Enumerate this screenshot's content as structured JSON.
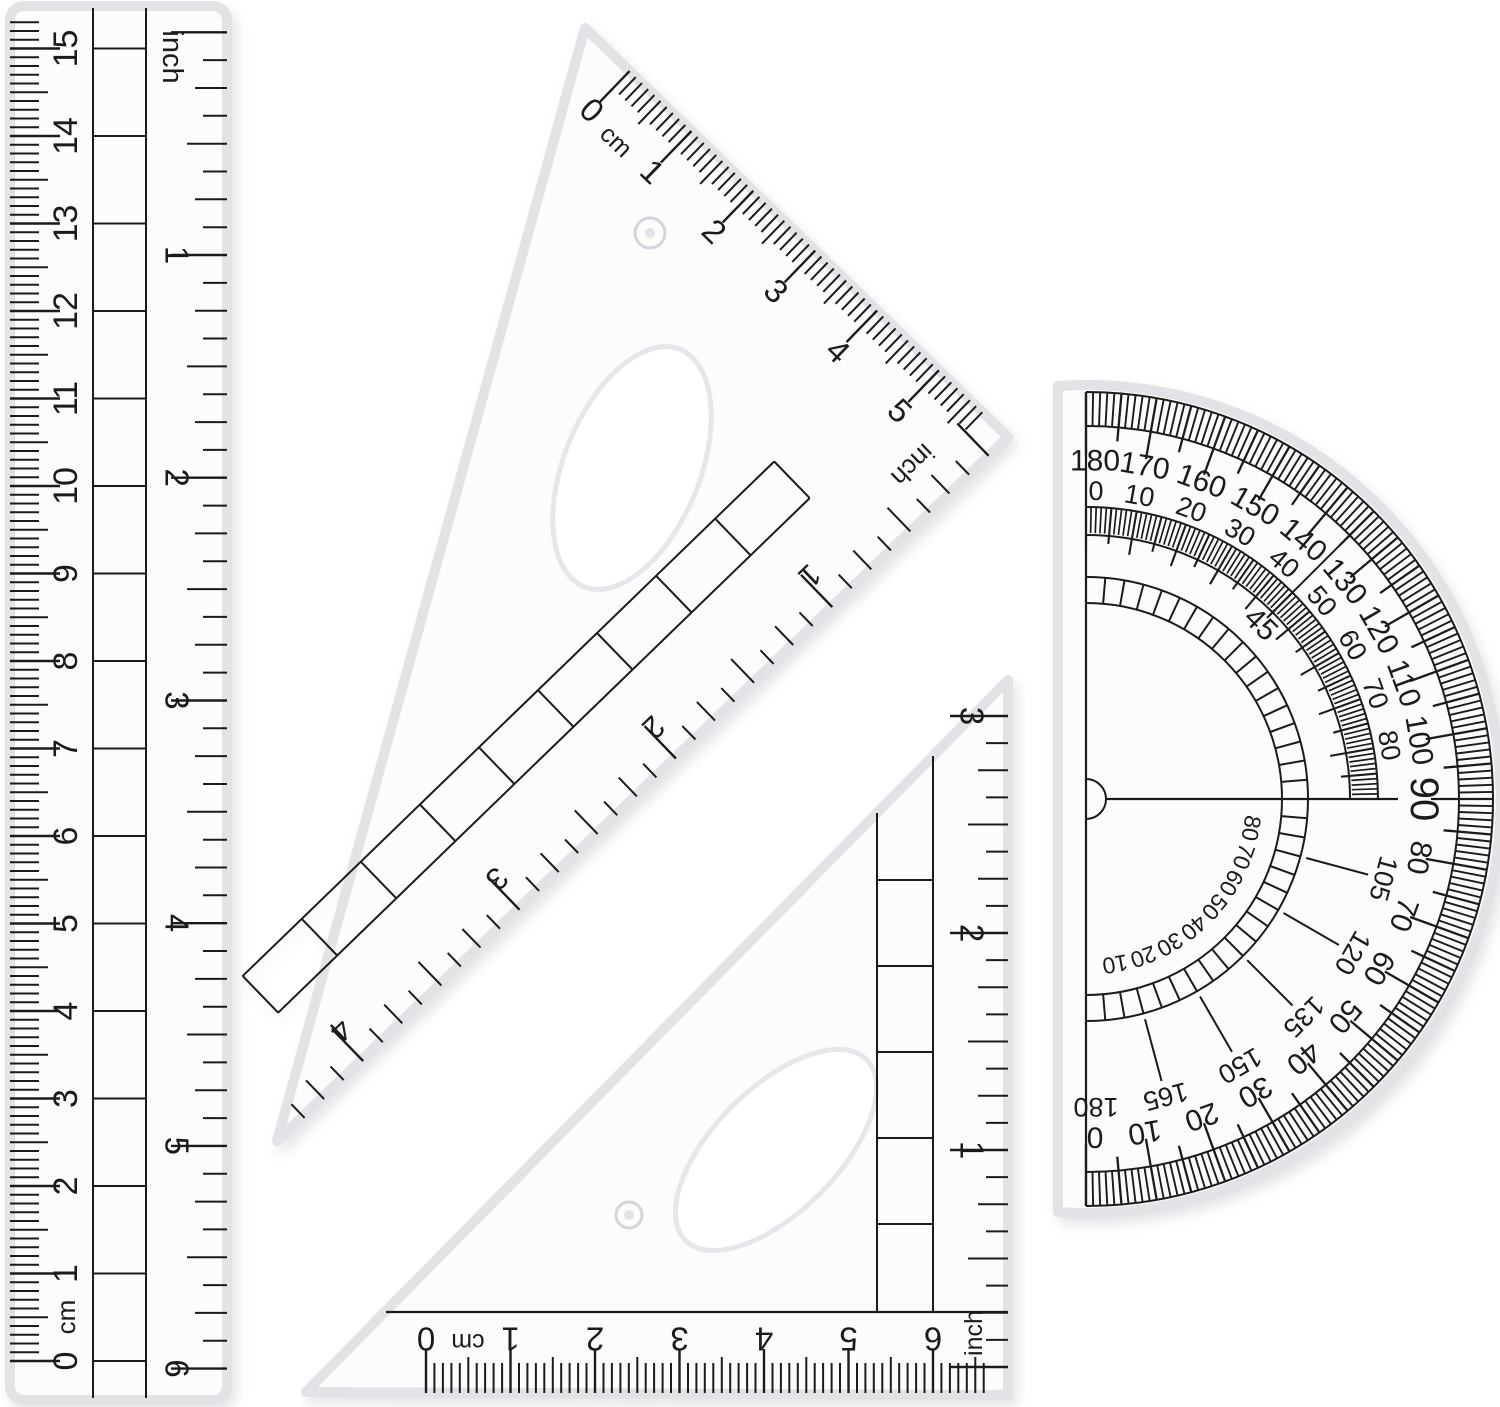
{
  "scene": {
    "description": "Transparent plastic geometry set on a white background: a 15 cm / 6 inch ruler, a 30-60-90 set square, a 45 set square, and a 180-degree protractor"
  },
  "colors": {
    "background": "#ffffff",
    "ink": "#1b1b1b",
    "plastic_fill": "#fcfcfd",
    "plastic_edge": "#e2e2e7",
    "hole_edge": "#e6e6eb"
  },
  "ruler": {
    "cm_zero": "0",
    "cm_unit": "cm",
    "cm_numbers": [
      "1",
      "2",
      "3",
      "4",
      "5",
      "6",
      "7",
      "8",
      "9",
      "10",
      "11",
      "12",
      "13",
      "14",
      "15"
    ],
    "inch_label": "inch",
    "inch_numbers": [
      "1",
      "2",
      "3",
      "4",
      "5",
      "6"
    ]
  },
  "set_square_60": {
    "cm_zero": "0",
    "cm_unit": "cm",
    "cm_numbers": [
      "1",
      "2",
      "3",
      "4",
      "5"
    ],
    "inch_label": "inch",
    "inch_numbers": [
      "1",
      "2",
      "3",
      "4"
    ]
  },
  "set_square_45": {
    "cm_zero": "0",
    "cm_unit": "cm",
    "cm_numbers": [
      "1",
      "2",
      "3",
      "4",
      "5",
      "6"
    ],
    "inch_label": "inch",
    "inch_numbers": [
      "1",
      "2",
      "3"
    ]
  },
  "protractor": {
    "outer_numbers": [
      "180",
      "170",
      "160",
      "150",
      "140",
      "130",
      "120",
      "110",
      "100",
      "90",
      "80",
      "70",
      "60",
      "50",
      "40",
      "30",
      "20",
      "10",
      "0"
    ],
    "middle_upper_numbers": [
      "0",
      "10",
      "20",
      "30",
      "40",
      "50",
      "60",
      "70",
      "80"
    ],
    "middle_lower_numbers": [
      "105",
      "120",
      "135",
      "150",
      "165",
      "180"
    ],
    "inner_lower_numbers": [
      "80",
      "70",
      "60",
      "50",
      "40",
      "30",
      "20",
      "10"
    ],
    "ladder_label": "45"
  }
}
